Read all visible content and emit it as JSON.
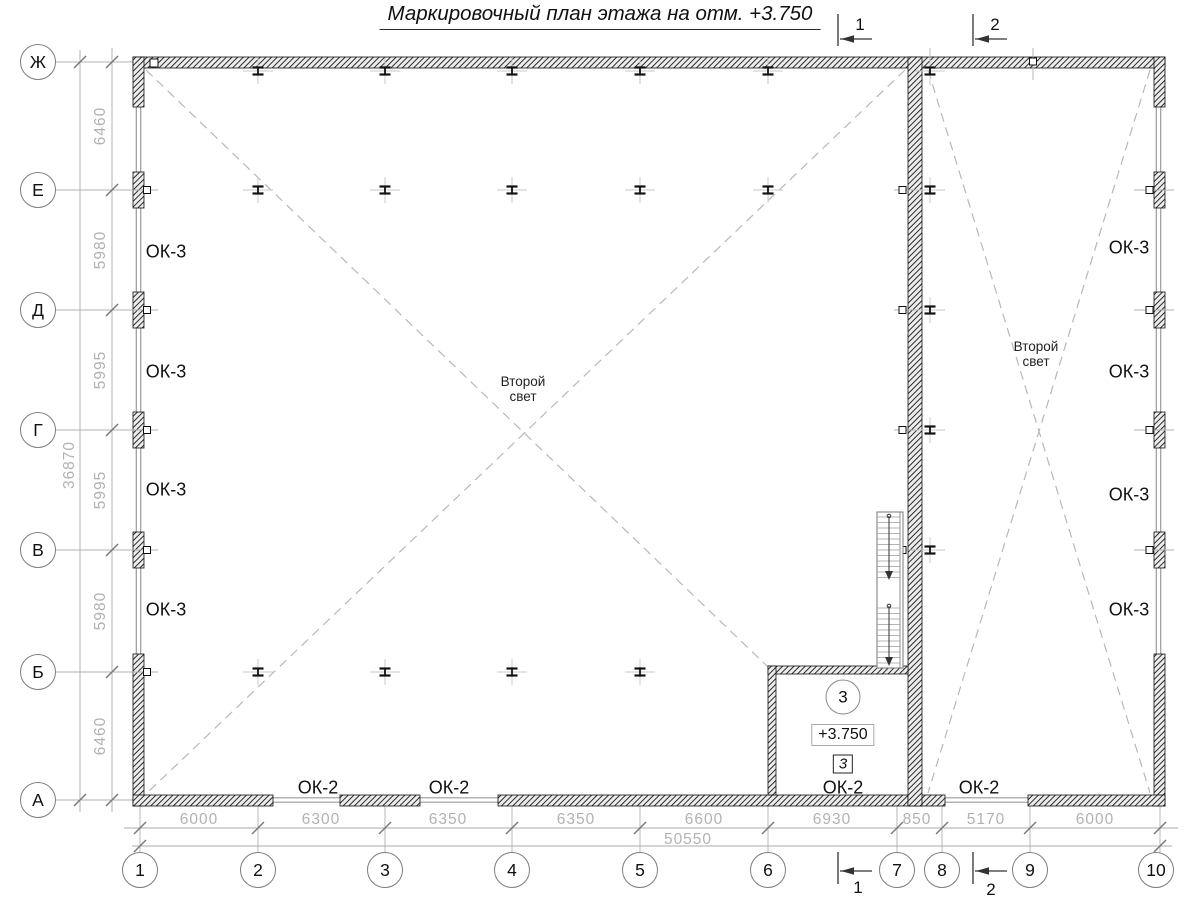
{
  "title": "Маркировочный план этажа на отм. +3.750",
  "colors": {
    "wall": "#1a1a1a",
    "window_line": "#9a9a9a",
    "dim_text": "#b2b2b2",
    "aux_line": "#b0b0b0",
    "dashed_line": "#b8b8b8",
    "text": "#111111"
  },
  "grid": {
    "rows": [
      "Ж",
      "Е",
      "Д",
      "Г",
      "В",
      "Б",
      "А"
    ],
    "cols": [
      "1",
      "2",
      "3",
      "4",
      "5",
      "6",
      "7",
      "8",
      "9",
      "10"
    ]
  },
  "dims": {
    "left": [
      "6460",
      "5980",
      "5995",
      "5995",
      "5980",
      "6460"
    ],
    "left_total": "36870",
    "bottom": [
      "6000",
      "6300",
      "6350",
      "6350",
      "6600",
      "6930",
      "850",
      "5170",
      "6000"
    ],
    "bottom_total": "50550"
  },
  "sections": {
    "s1": "1",
    "s2": "2"
  },
  "windows": {
    "ok3": "ОК-3",
    "ok2": "ОК-2"
  },
  "annotations": {
    "second_light": "Второй свет"
  },
  "room": {
    "number": "3",
    "elevation": "+3.750",
    "type": "3"
  }
}
